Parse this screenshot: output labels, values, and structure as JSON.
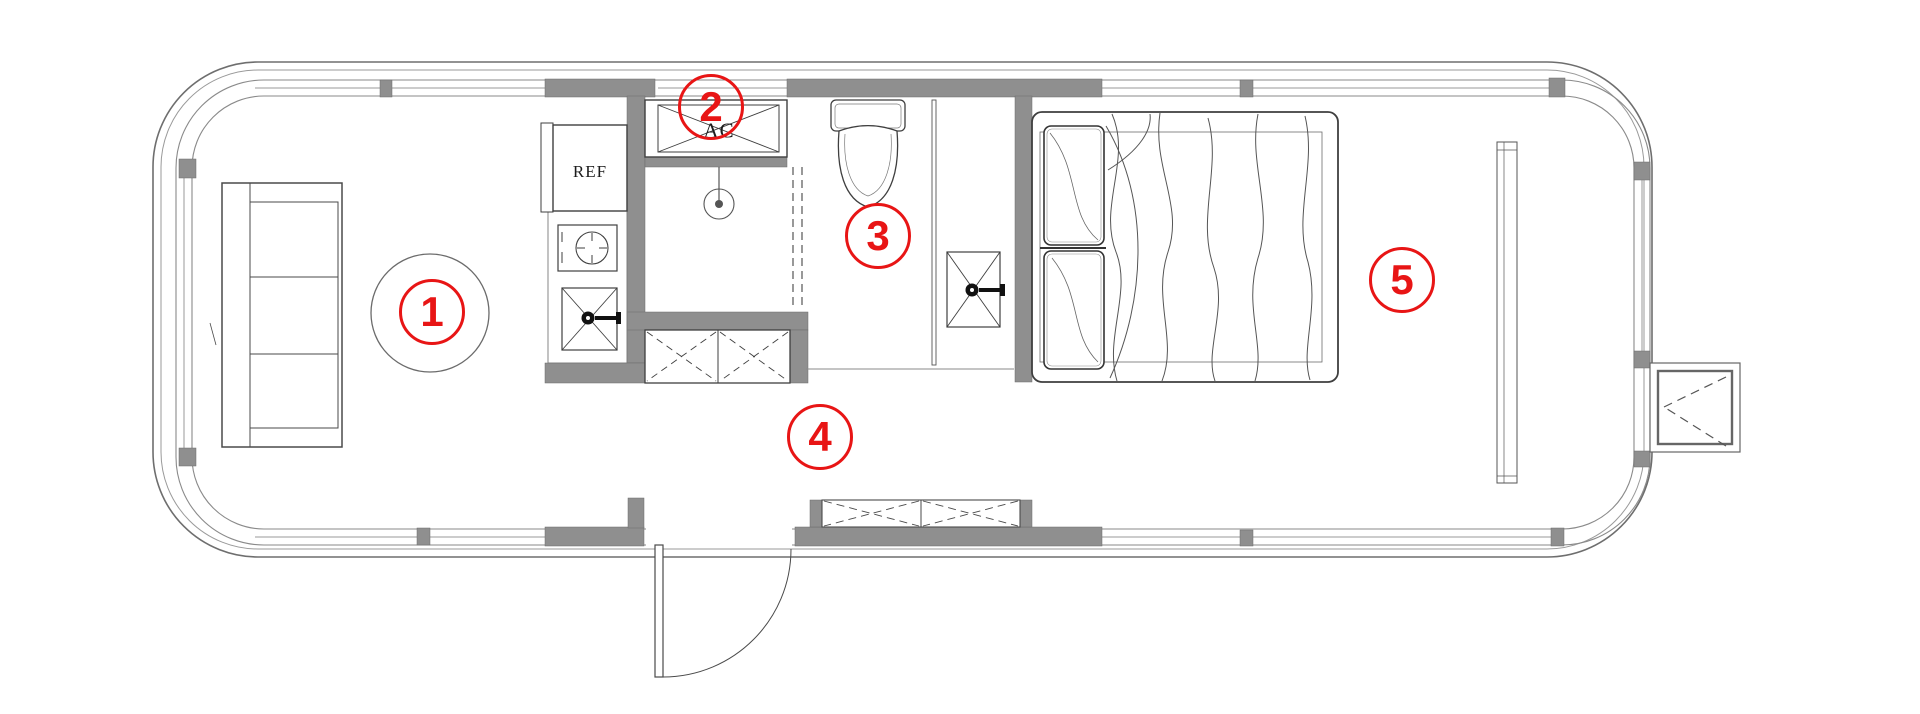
{
  "document": {
    "type": "floor-plan"
  },
  "labels": {
    "refrigerator": "REF",
    "air_conditioner": "AC"
  },
  "zone_markers": [
    {
      "number": "1"
    },
    {
      "number": "2"
    },
    {
      "number": "3"
    },
    {
      "number": "4"
    },
    {
      "number": "5"
    }
  ],
  "colors": {
    "marker_red": "#e81515",
    "wall_gray": "#8f8f8f",
    "line_dark": "#3f3f3f",
    "shell_gray": "#777777",
    "background": "#ffffff"
  }
}
